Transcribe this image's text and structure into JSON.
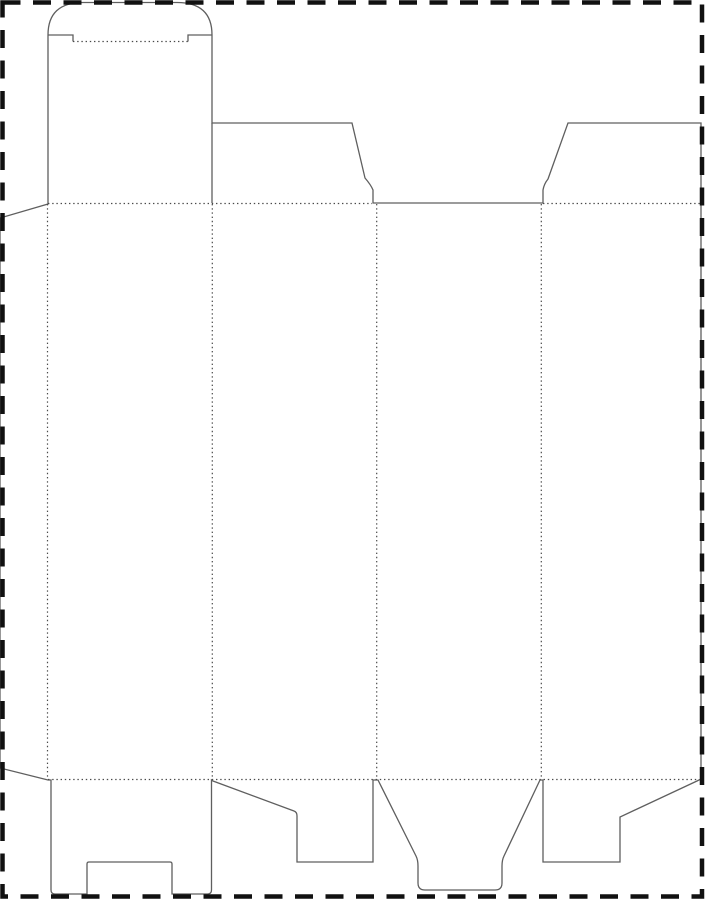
{
  "meta": {
    "description": "Flat packaging carton dieline (tuck-end box blank) on a page with dashed cut border",
    "canvas": {
      "width": 705,
      "height": 900
    },
    "background": "#ffffff"
  },
  "colors": {
    "board_fill": "#e7c5a4",
    "cut_line": "#5f5f5f",
    "fold_line": "#4a4a4a",
    "page_border": "#111111"
  },
  "page_border": {
    "name": "page-border",
    "x": 2.5,
    "y": 2.5,
    "width": 699.5,
    "height": 894,
    "stroke_width": 4.5,
    "dash": "18 12.5"
  },
  "carton": {
    "outline_width": 1.3,
    "silhouette": {
      "name": "carton-blank-silhouette",
      "d": "M 48,204 L 48,35 Q 48,2.5 83,2.5 L 177,2.5 Q 212,2.5 212,35 L 212,123 L 352,123 L 365,178 Q 371,185 373,190 L 373,203 L 543,203 L 543,190 Q 544,184 548,179 L 568,123 L 701,123 L 701,779 L 697,781 L 620,817 L 620,862 L 543,862 L 543,780 L 540,780 L 504,856 Q 502,860 502,866 L 502,883 Q 502,890 495,890 L 425,890 Q 418,890 418,883 L 418,866 Q 418,860 416,856 L 378,780 L 373,780 L 373,862 L 297,862 L 297,816 Q 297,812 294,811 L 213,781 L 211.5,780 L 211.5,890 Q 211.5,894 207.5,894 L 172,894 L 172,864 Q 172,862 170,862 L 89,862 Q 87,862 87,864 L 87,894 L 55,894 Q 51,894 51,890 L 51,780 L 48,780 L 0,768 L 0,218 Z"
    },
    "cut_lines": [
      {
        "name": "tuck-flap-dust-flap-cut",
        "d": "M 212,123 L 212,203"
      },
      {
        "name": "tongue-slit-left",
        "d": "M 48,35 L 73,35 L 73,41.5"
      },
      {
        "name": "tongue-slit-right",
        "d": "M 212,35 L 188,35 L 188,41.5"
      }
    ],
    "fold_lines": [
      {
        "name": "tongue-fold",
        "d": "M 73,41.5 L 188,41.5"
      },
      {
        "name": "top-fold-left",
        "d": "M 48,203.5 L 372,203.5"
      },
      {
        "name": "top-fold-right",
        "d": "M 543,203.5 L 700,203.5"
      },
      {
        "name": "bottom-fold",
        "d": "M 48,779.5 L 697,779.5"
      },
      {
        "name": "vertical-fold-glue-flap",
        "d": "M 47.5,204 L 47.5,779"
      },
      {
        "name": "vertical-fold-panel-1-2",
        "d": "M 212.3,204 L 212.3,779"
      },
      {
        "name": "vertical-fold-panel-2-3",
        "d": "M 376.7,204 L 376.7,779"
      },
      {
        "name": "vertical-fold-panel-3-4",
        "d": "M 541.3,204 L 541.3,779"
      }
    ],
    "fold_style": {
      "width": 1.2,
      "dash": "1.4 2.8"
    }
  }
}
